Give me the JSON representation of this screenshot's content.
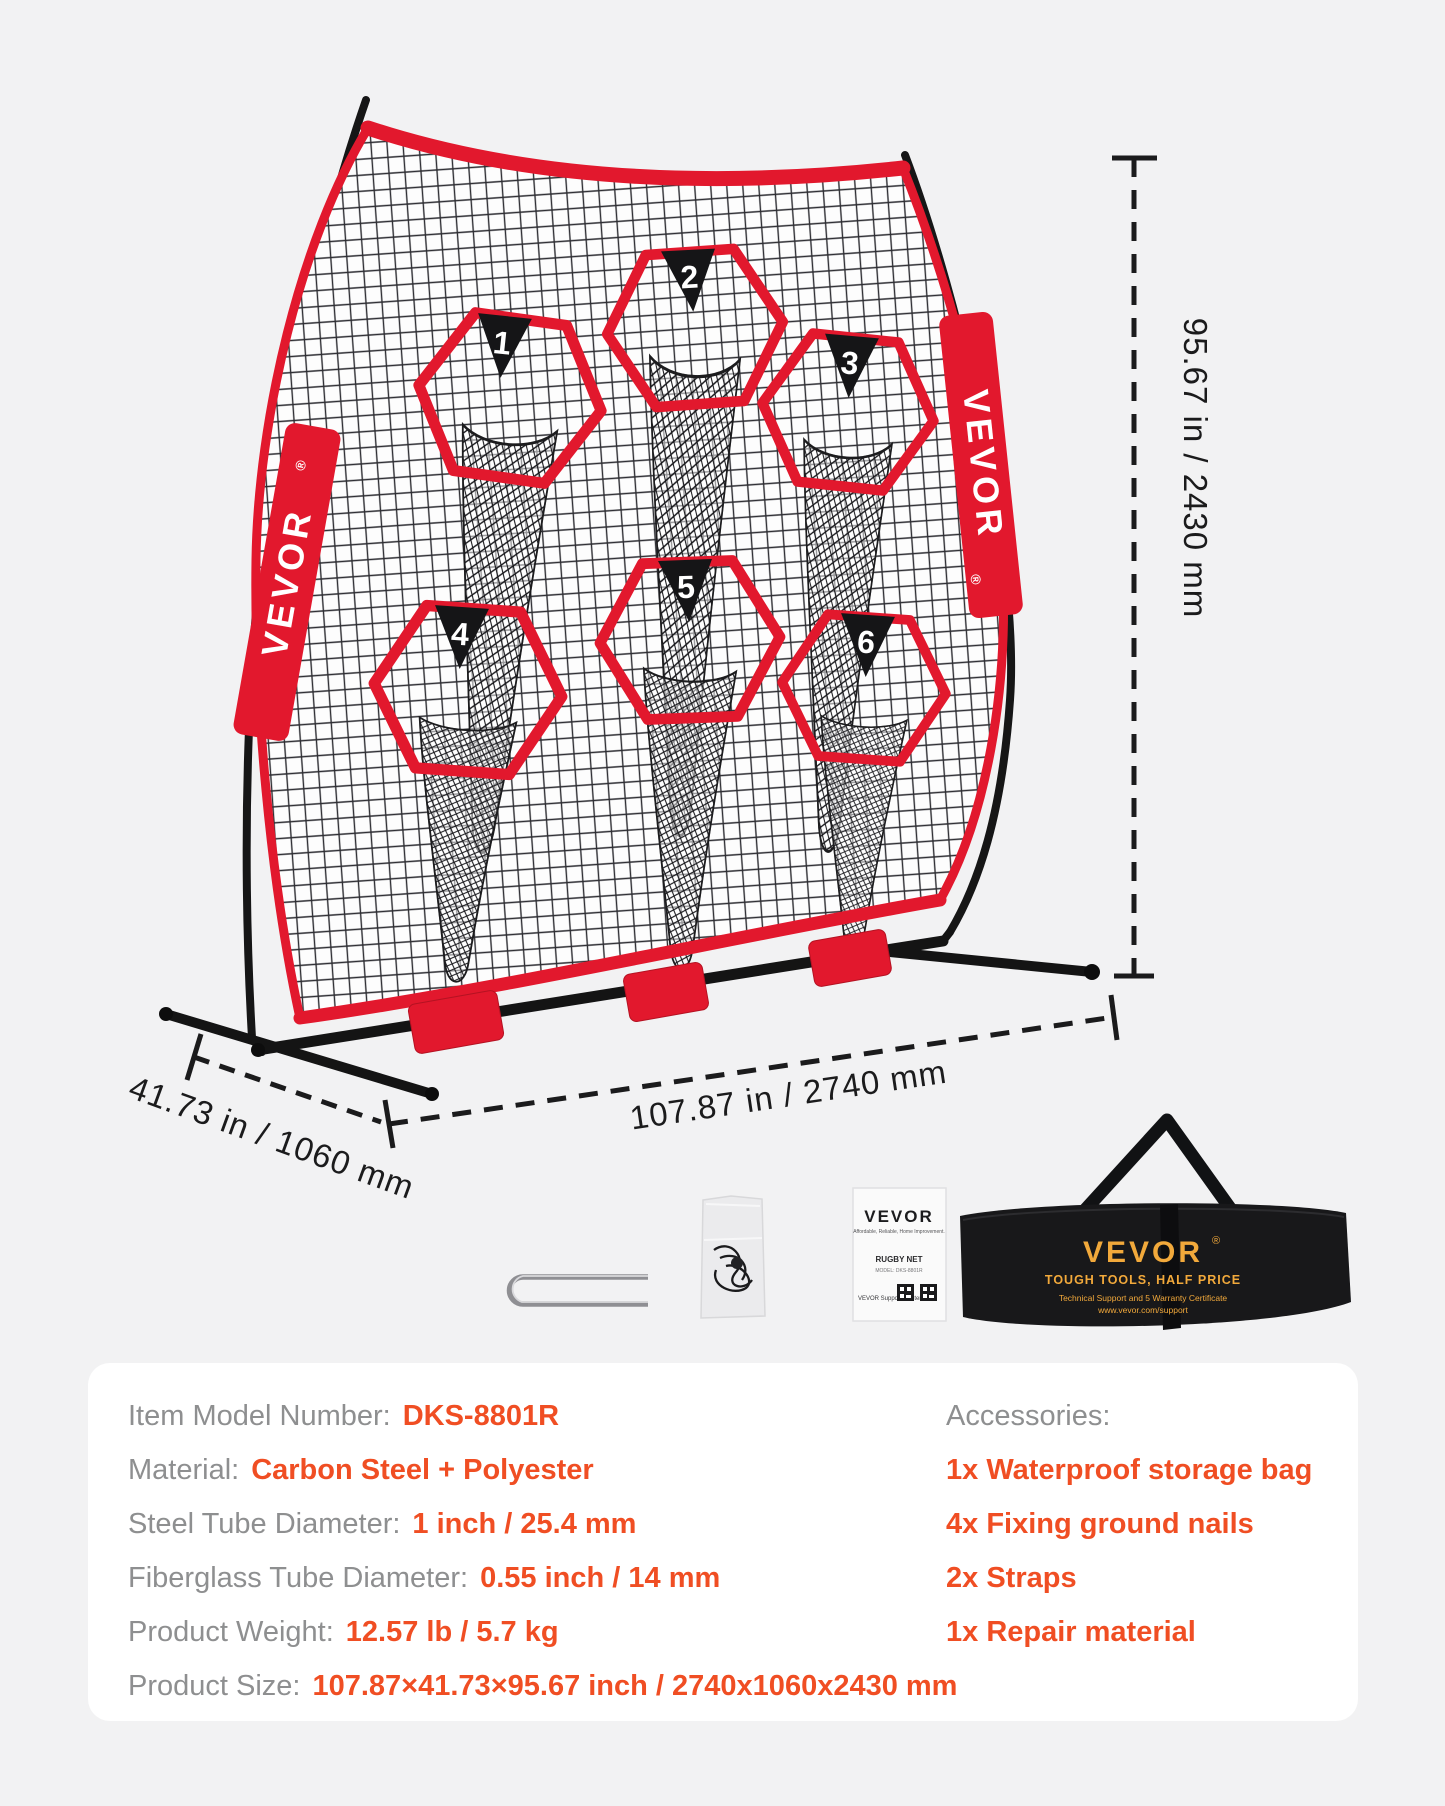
{
  "page": {
    "background": "#f2f2f3"
  },
  "brand": {
    "name": "VEVOR",
    "reg": "®"
  },
  "net": {
    "targets": [
      "1",
      "2",
      "3",
      "4",
      "5",
      "6"
    ]
  },
  "dimensions": {
    "height": "95.67 in / 2430 mm",
    "width": "107.87 in / 2740 mm",
    "depth": "41.73 in / 1060 mm"
  },
  "manual": {
    "brand": "VEVOR",
    "tagline": "Affordable, Reliable, Home Improvement.",
    "product": "RUGBY NET",
    "model_line": "MODEL: DKS-8801R",
    "support": "VEVOR Support Center"
  },
  "storage_bag": {
    "brand": "VEVOR",
    "reg": "®",
    "slogan": "TOUGH TOOLS, HALF PRICE",
    "line1": "Technical Support and 5 Warranty Certificate",
    "line2": "www.vevor.com/support"
  },
  "specs": {
    "rows": [
      {
        "label": "Item Model Number:",
        "value": "DKS-8801R"
      },
      {
        "label": "Material:",
        "value": "Carbon Steel + Polyester"
      },
      {
        "label": "Steel Tube Diameter:",
        "value": "1 inch / 25.4 mm"
      },
      {
        "label": "Fiberglass Tube Diameter:",
        "value": "0.55 inch / 14 mm"
      },
      {
        "label": "Product Weight:",
        "value": "12.57 lb / 5.7 kg"
      },
      {
        "label": "Product Size:",
        "value": "107.87×41.73×95.67 inch / 2740x1060x2430 mm"
      }
    ],
    "accessories_title": "Accessories:",
    "accessories_items": [
      "1x Waterproof storage bag",
      "4x Fixing ground nails",
      "2x Straps",
      "1x Repair material"
    ]
  },
  "colors": {
    "red": "#e2182d",
    "orange": "#f04e23",
    "label_gray": "#8e8f90",
    "gold": "#f2a93b",
    "ink": "#1b1b1c",
    "panel": "#ffffff",
    "background": "#f2f2f3"
  }
}
